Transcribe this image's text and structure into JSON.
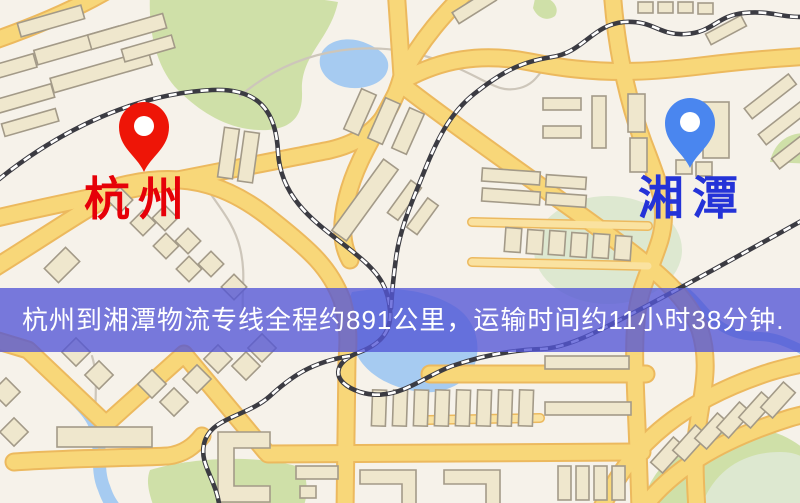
{
  "page": {
    "type": "logistics-route-map",
    "width_px": 800,
    "height_px": 503
  },
  "banner": {
    "text": "杭州到湘潭物流专线全程约891公里，运输时间约11小时38分钟.",
    "background": "#5356d6",
    "background_opacity": 0.78,
    "text_color": "#ffffff"
  },
  "route": {
    "origin": "杭州",
    "destination": "湘潭",
    "distance_text": "约891公里",
    "duration_text": "约11小时38分钟"
  },
  "markers": {
    "origin": {
      "label": "杭州",
      "pin_color": "#ee1507",
      "pin_hole_color": "#ffffff",
      "label_color": "#e60008",
      "x": 144,
      "y": 172
    },
    "destination": {
      "label": "湘潭",
      "pin_color": "#4a86ef",
      "pin_hole_color": "#ffffff",
      "label_color": "#2433d8",
      "x": 690,
      "y": 168
    }
  },
  "map": {
    "style_colors": {
      "background": "#f6f2ea",
      "road_fill": "#f8d779",
      "road_casing": "#ecb95e",
      "building_fill": "#efe7cd",
      "building_outline": "#a39a88",
      "green_area": "#cfe0a8",
      "water": "#a6cbf1",
      "railway": "#3b3b42"
    }
  }
}
